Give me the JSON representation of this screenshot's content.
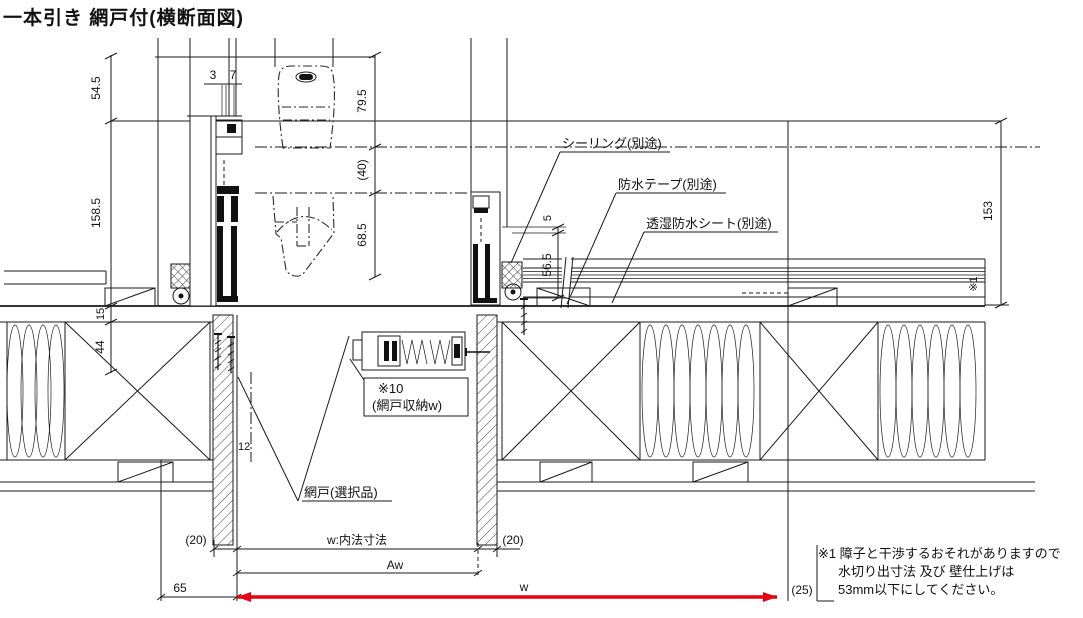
{
  "title": "一本引き 網戸付(横断面図)",
  "colors": {
    "line": "#1a1a1a",
    "accent_red": "#e60012",
    "background": "#ffffff"
  },
  "dims": {
    "left_54_5": "54.5",
    "left_158_5": "158.5",
    "left_15": "15",
    "left_44": "44",
    "top_3": "3",
    "top_7": "7",
    "mid_79_5": "79.5",
    "mid_40": "(40)",
    "mid_68_5": "68.5",
    "right_5": "5",
    "right_56_5": "56.5",
    "far_153": "153",
    "far_ref": "※1",
    "trim_12": "12",
    "bot_65": "65",
    "bot_20_left": "(20)",
    "bot_w_inner": "w:内法寸法",
    "bot_20_right": "(20)",
    "bot_aw": "Aw",
    "bot_w": "w",
    "bot_25": "(25)"
  },
  "labels": {
    "sealing": "シーリング(別途)",
    "tape": "防水テープ(別途)",
    "sheet": "透湿防水シート(別途)",
    "screen_ref": "※10",
    "screen_stock": "(網戸収納w)",
    "screen": "網戸(選択品)"
  },
  "note": {
    "l1": "※1 障子と干渉するおそれがありますので",
    "l2": "水切り出寸法 及び 壁仕上げは",
    "l3": "53mm以下にしてください。"
  }
}
